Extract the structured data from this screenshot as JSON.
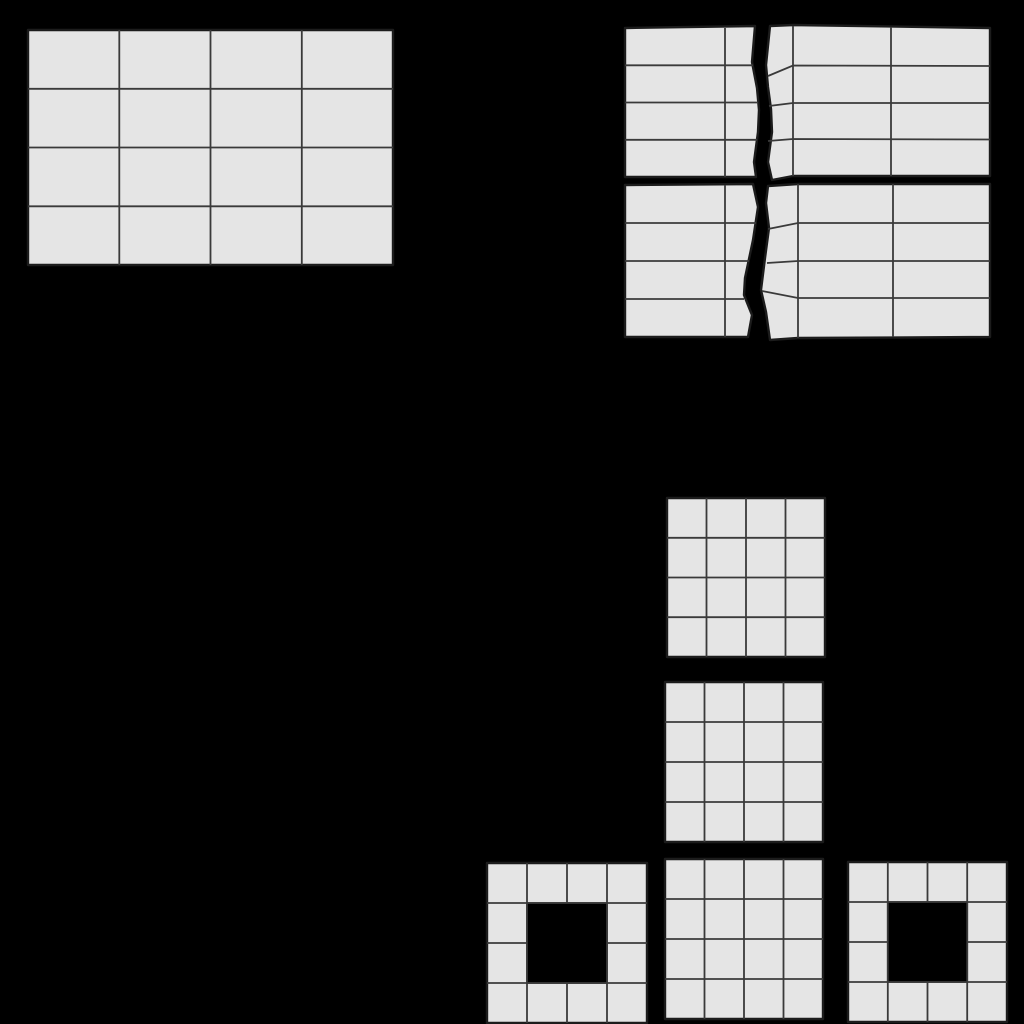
{
  "canvas": {
    "width": 1024,
    "height": 1024,
    "background": "#000000"
  },
  "palette": {
    "background": "#000000",
    "cell_fill": "#e5e5e5",
    "inner_line": "#3a3a3a",
    "outer_line": "#1c1c1c",
    "inner_width": 1.8,
    "outer_width": 2.4
  },
  "shapes": [
    {
      "id": "bar-grid-whole",
      "rows": 4,
      "cols": 4,
      "outline": [
        [
          28,
          30
        ],
        [
          393,
          30
        ],
        [
          393,
          265
        ],
        [
          28,
          265
        ]
      ],
      "lines": [
        [
          [
            119.3,
            30
          ],
          [
            119.3,
            265
          ]
        ],
        [
          [
            210.5,
            30
          ],
          [
            210.5,
            265
          ]
        ],
        [
          [
            301.8,
            30
          ],
          [
            301.8,
            265
          ]
        ],
        [
          [
            28,
            88.8
          ],
          [
            393,
            88.8
          ]
        ],
        [
          [
            28,
            147.5
          ],
          [
            393,
            147.5
          ]
        ],
        [
          [
            28,
            206.3
          ],
          [
            393,
            206.3
          ]
        ]
      ]
    },
    {
      "id": "torn-bar-top-left-fragment",
      "rows": 4,
      "outline": [
        [
          625,
          28
        ],
        [
          755,
          26
        ],
        [
          752,
          62
        ],
        [
          757,
          88
        ],
        [
          759,
          110
        ],
        [
          758,
          132
        ],
        [
          754,
          162
        ],
        [
          756,
          177
        ],
        [
          625,
          177
        ]
      ],
      "lines": [
        [
          [
            725,
            28
          ],
          [
            725,
            177
          ]
        ],
        [
          [
            625,
            65.3
          ],
          [
            753,
            65.3
          ]
        ],
        [
          [
            625,
            102.5
          ],
          [
            758,
            102.5
          ]
        ],
        [
          [
            625,
            139.8
          ],
          [
            757,
            139.8
          ]
        ]
      ]
    },
    {
      "id": "torn-bar-top-right-fragment",
      "rows": 4,
      "outline": [
        [
          770,
          26
        ],
        [
          793,
          25
        ],
        [
          990,
          28
        ],
        [
          990,
          176
        ],
        [
          793,
          176
        ],
        [
          772,
          180
        ],
        [
          768,
          162
        ],
        [
          772,
          132
        ],
        [
          771,
          109
        ],
        [
          768,
          87
        ],
        [
          766,
          65
        ]
      ],
      "lines": [
        [
          [
            793,
            26
          ],
          [
            793,
            176
          ]
        ],
        [
          [
            891,
            27
          ],
          [
            891,
            176
          ]
        ],
        [
          [
            768,
            76
          ],
          [
            793,
            65.5
          ],
          [
            990,
            66
          ]
        ],
        [
          [
            769,
            106
          ],
          [
            793,
            103
          ],
          [
            990,
            103
          ]
        ],
        [
          [
            768,
            141
          ],
          [
            793,
            139
          ],
          [
            990,
            139.5
          ]
        ]
      ]
    },
    {
      "id": "torn-bar-bottom-left-fragment",
      "rows": 4,
      "outline": [
        [
          625,
          185
        ],
        [
          753,
          184
        ],
        [
          758,
          207
        ],
        [
          753,
          240
        ],
        [
          745,
          278
        ],
        [
          744,
          295
        ],
        [
          752,
          315
        ],
        [
          748,
          337
        ],
        [
          625,
          337
        ]
      ],
      "lines": [
        [
          [
            725,
            185
          ],
          [
            725,
            337
          ]
        ],
        [
          [
            625,
            223
          ],
          [
            756,
            223
          ]
        ],
        [
          [
            625,
            261
          ],
          [
            749,
            261
          ]
        ],
        [
          [
            625,
            299
          ],
          [
            744,
            299
          ]
        ]
      ]
    },
    {
      "id": "torn-bar-bottom-right-fragment",
      "rows": 4,
      "outline": [
        [
          768,
          186
        ],
        [
          798,
          184
        ],
        [
          990,
          184
        ],
        [
          990,
          337
        ],
        [
          798,
          338
        ],
        [
          770,
          340
        ],
        [
          766,
          312
        ],
        [
          761,
          290
        ],
        [
          765,
          258
        ],
        [
          769,
          228
        ],
        [
          766,
          203
        ]
      ],
      "lines": [
        [
          [
            798,
            184
          ],
          [
            798,
            338
          ]
        ],
        [
          [
            893,
            184
          ],
          [
            893,
            337
          ]
        ],
        [
          [
            768,
            229
          ],
          [
            798,
            223
          ],
          [
            990,
            223
          ]
        ],
        [
          [
            767,
            263
          ],
          [
            798,
            261
          ],
          [
            990,
            261
          ]
        ],
        [
          [
            762,
            291
          ],
          [
            798,
            298
          ],
          [
            990,
            298
          ]
        ]
      ]
    },
    {
      "id": "square-grid-upper",
      "rows": 4,
      "cols": 4,
      "outline": [
        [
          667,
          498
        ],
        [
          825,
          498
        ],
        [
          825,
          657
        ],
        [
          667,
          657
        ]
      ],
      "lines": [
        [
          [
            706.5,
            498
          ],
          [
            706.5,
            657
          ]
        ],
        [
          [
            746,
            498
          ],
          [
            746,
            657
          ]
        ],
        [
          [
            785.5,
            498
          ],
          [
            785.5,
            657
          ]
        ],
        [
          [
            667,
            537.8
          ],
          [
            825,
            537.8
          ]
        ],
        [
          [
            667,
            577.5
          ],
          [
            825,
            577.5
          ]
        ],
        [
          [
            667,
            617.2
          ],
          [
            825,
            617.2
          ]
        ]
      ]
    },
    {
      "id": "square-grid-middle",
      "rows": 4,
      "cols": 4,
      "outline": [
        [
          665,
          682
        ],
        [
          823,
          682
        ],
        [
          823,
          842
        ],
        [
          665,
          842
        ]
      ],
      "lines": [
        [
          [
            704.5,
            682
          ],
          [
            704.5,
            842
          ]
        ],
        [
          [
            744,
            682
          ],
          [
            744,
            842
          ]
        ],
        [
          [
            783.5,
            682
          ],
          [
            783.5,
            842
          ]
        ],
        [
          [
            665,
            722
          ],
          [
            823,
            722
          ]
        ],
        [
          [
            665,
            762
          ],
          [
            823,
            762
          ]
        ],
        [
          [
            665,
            802
          ],
          [
            823,
            802
          ]
        ]
      ]
    },
    {
      "id": "square-grid-lower",
      "rows": 4,
      "cols": 4,
      "outline": [
        [
          665,
          859
        ],
        [
          823,
          859
        ],
        [
          823,
          1019
        ],
        [
          665,
          1019
        ]
      ],
      "lines": [
        [
          [
            704.5,
            859
          ],
          [
            704.5,
            1019
          ]
        ],
        [
          [
            744,
            859
          ],
          [
            744,
            1019
          ]
        ],
        [
          [
            783.5,
            859
          ],
          [
            783.5,
            1019
          ]
        ],
        [
          [
            665,
            899
          ],
          [
            823,
            899
          ]
        ],
        [
          [
            665,
            939
          ],
          [
            823,
            939
          ]
        ],
        [
          [
            665,
            979
          ],
          [
            823,
            979
          ]
        ]
      ]
    },
    {
      "id": "frame-grid-left",
      "rows": 4,
      "cols": 4,
      "hole_cells": "2x2-center",
      "outline": [
        [
          487,
          863
        ],
        [
          647,
          863
        ],
        [
          647,
          1023
        ],
        [
          487,
          1023
        ]
      ],
      "lines": [
        [
          [
            527,
            863
          ],
          [
            527,
            1023
          ]
        ],
        [
          [
            567,
            863
          ],
          [
            567,
            1023
          ]
        ],
        [
          [
            607,
            863
          ],
          [
            607,
            1023
          ]
        ],
        [
          [
            487,
            903
          ],
          [
            647,
            903
          ]
        ],
        [
          [
            487,
            943
          ],
          [
            647,
            943
          ]
        ],
        [
          [
            487,
            983
          ],
          [
            647,
            983
          ]
        ]
      ],
      "hole": {
        "x": 527,
        "y": 903,
        "w": 80,
        "h": 80
      }
    },
    {
      "id": "frame-grid-right",
      "rows": 4,
      "cols": 4,
      "hole_cells": "2x2-center",
      "outline": [
        [
          848,
          862
        ],
        [
          1007,
          862
        ],
        [
          1007,
          1022
        ],
        [
          848,
          1022
        ]
      ],
      "lines": [
        [
          [
            887.8,
            862
          ],
          [
            887.8,
            1022
          ]
        ],
        [
          [
            927.5,
            862
          ],
          [
            927.5,
            1022
          ]
        ],
        [
          [
            967.2,
            862
          ],
          [
            967.2,
            1022
          ]
        ],
        [
          [
            848,
            902
          ],
          [
            1007,
            902
          ]
        ],
        [
          [
            848,
            942
          ],
          [
            1007,
            942
          ]
        ],
        [
          [
            848,
            982
          ],
          [
            1007,
            982
          ]
        ]
      ],
      "hole": {
        "x": 887.8,
        "y": 902,
        "w": 79.4,
        "h": 80
      }
    }
  ]
}
